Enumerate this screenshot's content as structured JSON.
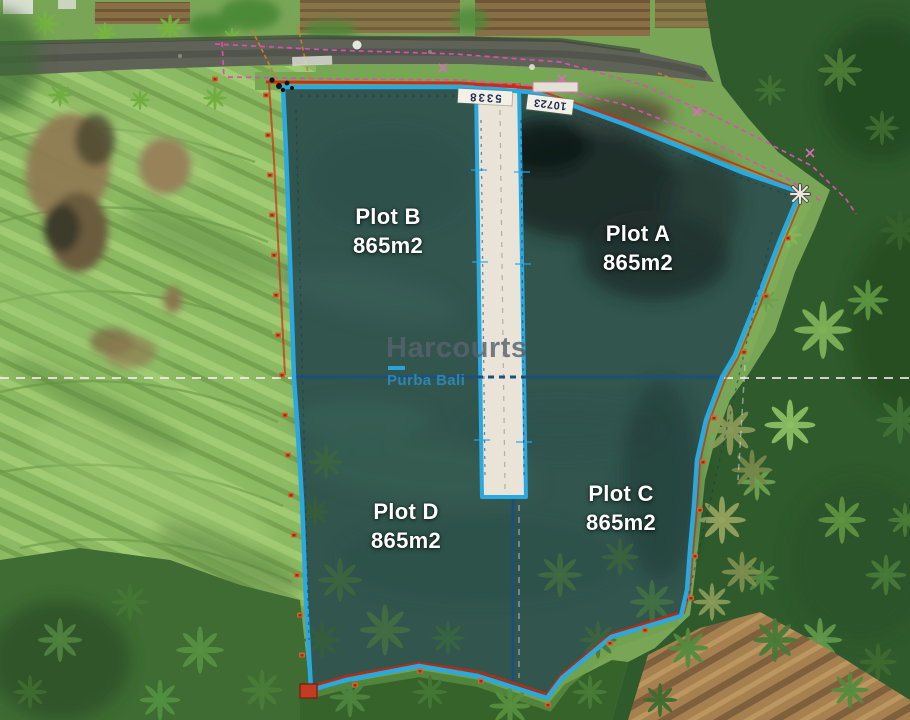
{
  "scene": {
    "description": "Aerial drone photo of four subdivided land plots outlined in cyan with survey lines",
    "watermark": {
      "brand": "Harcourts",
      "sub_brand": "Purba Bali"
    },
    "plots": {
      "a": {
        "name": "Plot A",
        "area": "865m2"
      },
      "b": {
        "name": "Plot B",
        "area": "865m2"
      },
      "c": {
        "name": "Plot C",
        "area": "865m2"
      },
      "d": {
        "name": "Plot D",
        "area": "865m2"
      }
    },
    "parcel_tags": {
      "strip": "5338",
      "north": "10723"
    },
    "colors": {
      "plot_boundary": "#2aa9e0",
      "division_line": "#1d4f7c",
      "survey_pink": "#d94fb3",
      "survey_red": "#cf2b12",
      "survey_yellow": "#d9a13c",
      "plot_label": "#ffffff"
    }
  }
}
